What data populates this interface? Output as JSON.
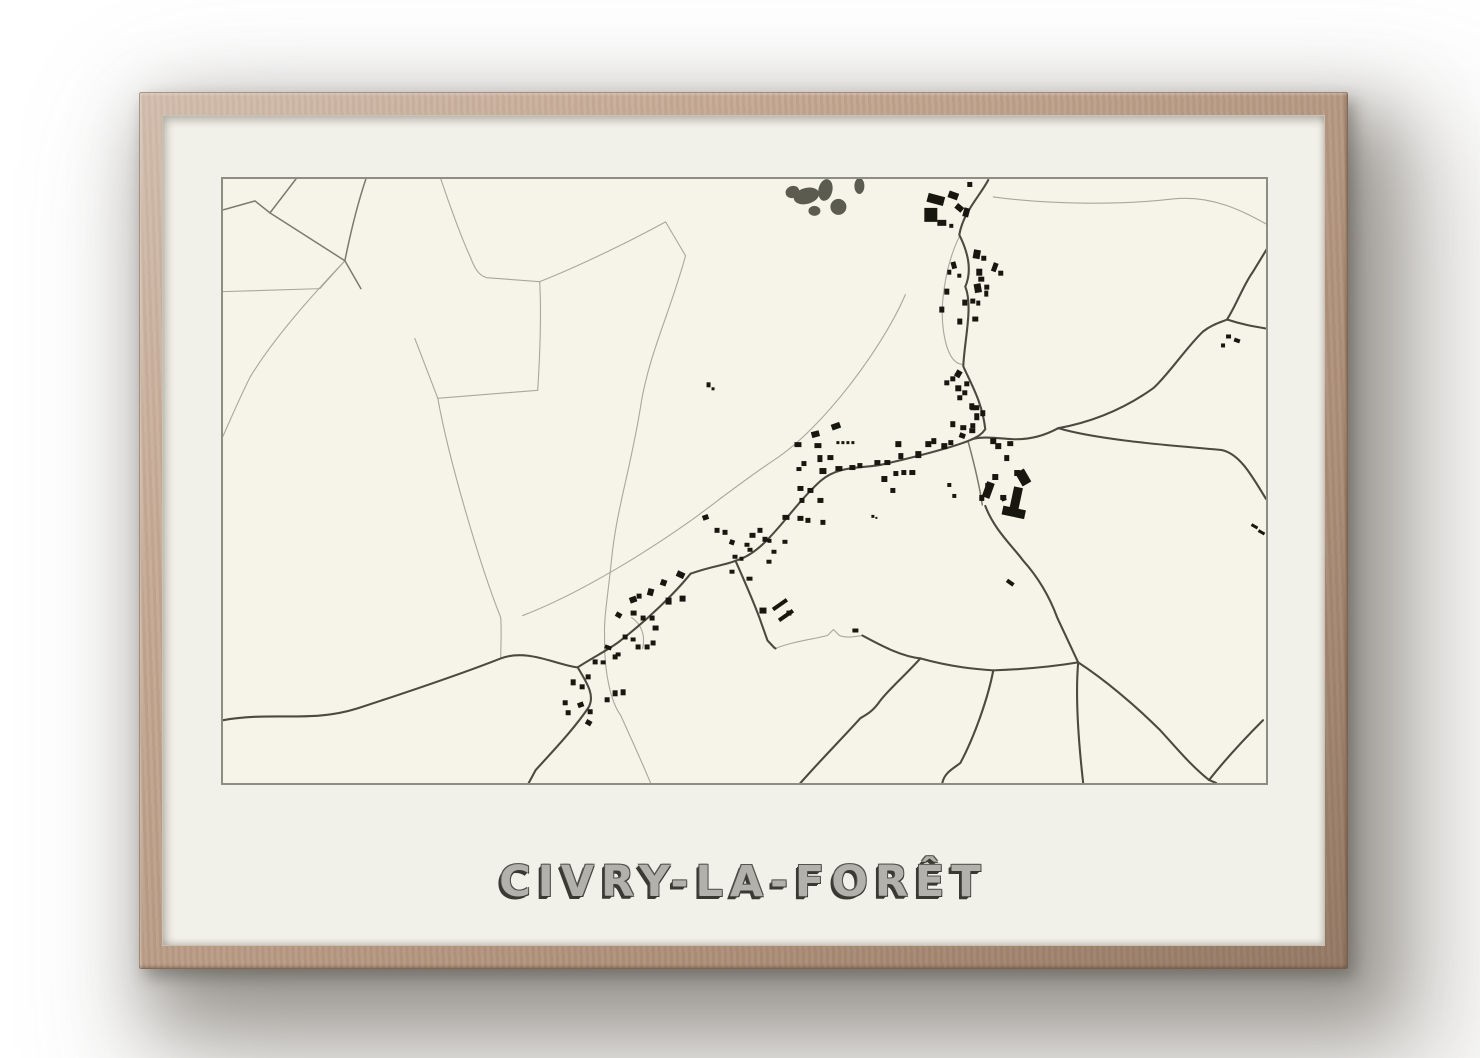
{
  "poster": {
    "title": "CIVRY-LA-FORÊT"
  },
  "colors": {
    "wood": "#bfa089",
    "mat": "#f2f1e9",
    "mapbg": "#f6f4e9",
    "mapborder": "#8d8d84",
    "roadlight": "#a9a79b",
    "roadmed": "#7c7a6e",
    "roaddark": "#4b4a40",
    "building": "#17170f",
    "forest": "#5b5b50",
    "titlefill": "#b2b1ab",
    "titledark": "#3a3a32",
    "titleedge": "#55544c"
  },
  "map": {
    "viewbox": "0 0 1044 606",
    "roads_dark": [
      "M0,543 C50,534 88,546 135,531 C190,513 240,496 278,481 C305,471 332,487 355,490",
      "M355,490 C372,479 390,470 398,463 C425,442 452,416 468,396 C490,388 505,387 513,383 C545,374 565,333 598,303 C618,286 642,291 662,286 C700,277 735,268 750,261",
      "M750,261 C760,258 775,260 790,261 C810,262 825,256 836,250",
      "M766,1 C757,18 741,33 737,56 C746,74 750,92 743,108 C751,128 742,162 741,188 C749,206 760,224 763,251 C759,257 754,259 750,261",
      "M836,250 C880,242 910,225 931,210 C945,198 965,168 981,153 C990,146 998,144 1005,141 C1015,125 1022,105 1031,93 L1045,70",
      "M836,250 C880,263 960,268 1000,272 C1018,276 1030,298 1044,321",
      "M1005,141 C1020,146 1032,148 1044,150",
      "M513,383 C520,399 533,428 539,446 L545,463 C550,468 551,470 553,471",
      "M640,458 C662,470 680,479 698,481 C730,490 756,492 771,493 C800,492 832,489 856,485",
      "M763,328 C772,352 790,368 801,383 C818,402 828,421 835,440 C844,459 850,472 856,485",
      "M856,485 C853,520 856,562 861,606",
      "M856,485 C882,502 912,527 938,553 C952,568 968,588 987,603 L994,606",
      "M987,603 C1002,584 1022,562 1041,543",
      "M698,481 C682,499 664,514 656,526 C650,534 645,537 638,541 C620,561 600,581 578,606",
      "M355,490 C366,508 372,519 366,530 C352,551 332,572 313,593 L306,606",
      "M771,493 C766,520 752,560 738,586 C730,592 722,596 720,606"
    ],
    "roads_medium": [
      "M0,31 L32,22 L47,34 L73,0",
      "M47,34 C75,52 100,68 122,82",
      "M143,0 C133,30 126,62 122,82 L138,110",
      "M746,264 C752,286 757,306 760,327"
    ],
    "roads_light": [
      "M122,82 L97,110 L0,113",
      "M122,82 C82,124 48,164 27,199 C17,219 8,240 0,258",
      "M218,0 C228,30 240,62 247,77 C252,90 256,97 264,99 L317,103",
      "M317,103 C360,86 412,60 443,43",
      "M443,43 L463,77 C447,135 428,172 419,222 C409,288 394,330 389,381 C385,420 381,442 382,458 C381,500 390,527 398,538 C408,560 418,582 428,606",
      "M317,103 C319,140 317,180 315,212",
      "M315,212 L215,220 L192,160",
      "M215,220 C226,282 258,390 278,440 C279,455 278,468 278,481",
      "M683,116 C660,170 600,250 553,281 C520,303 490,327 468,343 C430,370 360,415 300,438",
      "M737,58 C725,82 717,122 721,151 C724,174 731,186 741,186",
      "M771,18 C830,26 900,26 951,20 C990,16 1020,32 1044,45",
      "M553,471 C570,464 590,462 605,458 L611,452 L617,458 C625,461 633,459 640,458",
      "M409,440 C419,447 423,458 420,471"
    ],
    "forest_patches": [
      [
        584,
        17,
        13,
        8,
        -15
      ],
      [
        603,
        11,
        7,
        11,
        12
      ],
      [
        616,
        28,
        8,
        8,
        0
      ],
      [
        637,
        7,
        5,
        8,
        0
      ],
      [
        570,
        13,
        7,
        6,
        -20
      ],
      [
        592,
        32,
        6,
        5,
        0
      ]
    ],
    "buildings": [
      [
        745,
        3,
        5,
        5,
        0
      ],
      [
        705,
        16,
        17,
        9,
        15
      ],
      [
        726,
        13,
        10,
        7,
        20
      ],
      [
        702,
        29,
        13,
        14,
        0
      ],
      [
        733,
        26,
        8,
        6,
        40
      ],
      [
        715,
        41,
        9,
        6,
        0
      ],
      [
        727,
        45,
        4,
        4,
        0
      ],
      [
        741,
        29,
        6,
        9,
        15
      ],
      [
        751,
        71,
        7,
        9,
        10
      ],
      [
        759,
        77,
        5,
        5,
        0
      ],
      [
        729,
        83,
        5,
        7,
        -15
      ],
      [
        725,
        91,
        4,
        5,
        0
      ],
      [
        754,
        90,
        6,
        7,
        0
      ],
      [
        770,
        84,
        5,
        9,
        20
      ],
      [
        776,
        92,
        5,
        5,
        0
      ],
      [
        756,
        98,
        6,
        5,
        0
      ],
      [
        752,
        105,
        7,
        9,
        -10
      ],
      [
        762,
        106,
        5,
        5,
        0
      ],
      [
        722,
        110,
        5,
        6,
        0
      ],
      [
        735,
        95,
        4,
        4,
        0
      ],
      [
        762,
        112,
        4,
        6,
        0
      ],
      [
        717,
        128,
        5,
        6,
        0
      ],
      [
        740,
        121,
        5,
        6,
        0
      ],
      [
        748,
        120,
        5,
        5,
        0
      ],
      [
        754,
        122,
        4,
        5,
        0
      ],
      [
        735,
        140,
        5,
        6,
        0
      ],
      [
        750,
        138,
        6,
        5,
        0
      ],
      [
        733,
        192,
        6,
        7,
        30
      ],
      [
        728,
        198,
        5,
        5,
        0
      ],
      [
        722,
        202,
        5,
        5,
        0
      ],
      [
        733,
        207,
        6,
        6,
        0
      ],
      [
        742,
        203,
        5,
        5,
        0
      ],
      [
        740,
        212,
        5,
        5,
        0
      ],
      [
        735,
        217,
        5,
        5,
        0
      ],
      [
        747,
        225,
        5,
        6,
        0
      ],
      [
        752,
        227,
        5,
        5,
        0
      ],
      [
        728,
        243,
        5,
        6,
        0
      ],
      [
        738,
        247,
        6,
        5,
        0
      ],
      [
        748,
        245,
        5,
        5,
        0
      ],
      [
        572,
        264,
        7,
        5,
        0
      ],
      [
        589,
        253,
        8,
        6,
        -15
      ],
      [
        609,
        245,
        9,
        6,
        -20
      ],
      [
        592,
        265,
        7,
        5,
        0
      ],
      [
        595,
        277,
        5,
        7,
        0
      ],
      [
        605,
        277,
        6,
        5,
        0
      ],
      [
        579,
        283,
        5,
        5,
        0
      ],
      [
        574,
        289,
        5,
        4,
        0
      ],
      [
        597,
        290,
        7,
        6,
        0
      ],
      [
        613,
        288,
        7,
        5,
        0
      ],
      [
        627,
        287,
        6,
        5,
        0
      ],
      [
        635,
        285,
        5,
        5,
        0
      ],
      [
        614,
        263,
        3,
        3,
        0
      ],
      [
        619,
        263,
        3,
        3,
        0
      ],
      [
        624,
        263,
        3,
        3,
        0
      ],
      [
        629,
        263,
        3,
        3,
        0
      ],
      [
        652,
        282,
        6,
        5,
        0
      ],
      [
        662,
        282,
        6,
        5,
        0
      ],
      [
        673,
        263,
        6,
        6,
        0
      ],
      [
        676,
        275,
        5,
        6,
        0
      ],
      [
        659,
        298,
        6,
        6,
        0
      ],
      [
        668,
        310,
        5,
        5,
        0
      ],
      [
        671,
        293,
        5,
        5,
        0
      ],
      [
        679,
        292,
        5,
        5,
        0
      ],
      [
        687,
        292,
        6,
        5,
        0
      ],
      [
        693,
        273,
        6,
        7,
        0
      ],
      [
        703,
        263,
        6,
        6,
        0
      ],
      [
        709,
        260,
        5,
        6,
        0
      ],
      [
        719,
        265,
        6,
        6,
        0
      ],
      [
        726,
        262,
        5,
        5,
        0
      ],
      [
        737,
        255,
        6,
        5,
        20
      ],
      [
        747,
        250,
        6,
        5,
        0
      ],
      [
        752,
        235,
        5,
        7,
        0
      ],
      [
        748,
        227,
        5,
        5,
        0
      ],
      [
        758,
        232,
        5,
        6,
        0
      ],
      [
        768,
        260,
        6,
        6,
        0
      ],
      [
        773,
        265,
        6,
        6,
        0
      ],
      [
        785,
        263,
        6,
        5,
        0
      ],
      [
        782,
        277,
        5,
        6,
        0
      ],
      [
        792,
        292,
        6,
        6,
        0
      ],
      [
        800,
        298,
        6,
        6,
        0
      ],
      [
        763,
        305,
        6,
        6,
        0
      ],
      [
        757,
        317,
        5,
        6,
        0
      ],
      [
        778,
        317,
        6,
        5,
        0
      ],
      [
        793,
        310,
        6,
        5,
        0
      ],
      [
        779,
        319,
        5,
        4,
        -20
      ],
      [
        725,
        305,
        4,
        4,
        0
      ],
      [
        730,
        316,
        4,
        4,
        0
      ],
      [
        575,
        308,
        6,
        5,
        0
      ],
      [
        585,
        310,
        6,
        5,
        0
      ],
      [
        577,
        320,
        5,
        5,
        0
      ],
      [
        560,
        337,
        7,
        5,
        0
      ],
      [
        575,
        338,
        6,
        5,
        0
      ],
      [
        595,
        320,
        6,
        5,
        0
      ],
      [
        598,
        342,
        5,
        5,
        0
      ],
      [
        583,
        340,
        5,
        5,
        0
      ],
      [
        649,
        337,
        3,
        3,
        0
      ],
      [
        653,
        339,
        2,
        2,
        0
      ],
      [
        480,
        337,
        6,
        5,
        -20
      ],
      [
        492,
        350,
        5,
        5,
        0
      ],
      [
        500,
        352,
        5,
        5,
        0
      ],
      [
        507,
        362,
        5,
        5,
        20
      ],
      [
        527,
        355,
        6,
        5,
        0
      ],
      [
        535,
        350,
        5,
        5,
        0
      ],
      [
        522,
        365,
        5,
        4,
        0
      ],
      [
        525,
        370,
        5,
        4,
        0
      ],
      [
        540,
        359,
        5,
        5,
        0
      ],
      [
        545,
        361,
        4,
        4,
        0
      ],
      [
        510,
        377,
        5,
        4,
        0
      ],
      [
        517,
        379,
        4,
        4,
        0
      ],
      [
        507,
        392,
        5,
        4,
        0
      ],
      [
        524,
        399,
        6,
        4,
        0
      ],
      [
        544,
        382,
        5,
        4,
        0
      ],
      [
        549,
        372,
        5,
        4,
        0
      ],
      [
        560,
        362,
        5,
        4,
        0
      ],
      [
        407,
        419,
        7,
        6,
        -20
      ],
      [
        414,
        416,
        5,
        5,
        0
      ],
      [
        425,
        411,
        6,
        7,
        15
      ],
      [
        438,
        402,
        6,
        6,
        20
      ],
      [
        454,
        394,
        8,
        6,
        25
      ],
      [
        443,
        420,
        6,
        7,
        0
      ],
      [
        457,
        418,
        6,
        6,
        0
      ],
      [
        393,
        435,
        6,
        5,
        30
      ],
      [
        408,
        433,
        6,
        5,
        0
      ],
      [
        418,
        438,
        5,
        5,
        0
      ],
      [
        427,
        438,
        5,
        5,
        0
      ],
      [
        430,
        448,
        6,
        5,
        0
      ],
      [
        413,
        467,
        5,
        5,
        0
      ],
      [
        422,
        467,
        5,
        5,
        0
      ],
      [
        428,
        463,
        5,
        5,
        0
      ],
      [
        400,
        457,
        5,
        5,
        0
      ],
      [
        408,
        460,
        5,
        4,
        0
      ],
      [
        382,
        468,
        7,
        4,
        20
      ],
      [
        390,
        477,
        5,
        5,
        0
      ],
      [
        370,
        482,
        5,
        5,
        0
      ],
      [
        378,
        483,
        5,
        4,
        0
      ],
      [
        393,
        475,
        5,
        4,
        0
      ],
      [
        348,
        502,
        5,
        6,
        0
      ],
      [
        357,
        507,
        5,
        5,
        0
      ],
      [
        363,
        497,
        5,
        5,
        0
      ],
      [
        340,
        523,
        5,
        5,
        0
      ],
      [
        355,
        525,
        6,
        5,
        -20
      ],
      [
        343,
        533,
        5,
        5,
        0
      ],
      [
        365,
        532,
        5,
        5,
        0
      ],
      [
        363,
        543,
        6,
        5,
        30
      ],
      [
        382,
        520,
        5,
        5,
        0
      ],
      [
        390,
        513,
        5,
        6,
        0
      ],
      [
        398,
        512,
        5,
        6,
        0
      ],
      [
        549,
        425,
        17,
        4,
        -35
      ],
      [
        555,
        436,
        17,
        4,
        -35
      ],
      [
        537,
        430,
        7,
        6,
        0
      ],
      [
        564,
        433,
        5,
        5,
        0
      ],
      [
        789,
        309,
        9,
        27,
        12
      ],
      [
        780,
        330,
        23,
        9,
        12
      ],
      [
        796,
        292,
        10,
        15,
        -30
      ],
      [
        770,
        296,
        6,
        6,
        0
      ],
      [
        762,
        304,
        8,
        16,
        20
      ],
      [
        484,
        204,
        4,
        5,
        0
      ],
      [
        489,
        209,
        3,
        3,
        0
      ],
      [
        1004,
        156,
        5,
        4,
        0
      ],
      [
        1012,
        160,
        6,
        4,
        20
      ],
      [
        999,
        165,
        4,
        4,
        0
      ],
      [
        1029,
        347,
        7,
        3,
        30
      ],
      [
        1036,
        353,
        7,
        3,
        30
      ],
      [
        784,
        403,
        8,
        4,
        35
      ],
      [
        630,
        451,
        6,
        4,
        0
      ]
    ]
  }
}
